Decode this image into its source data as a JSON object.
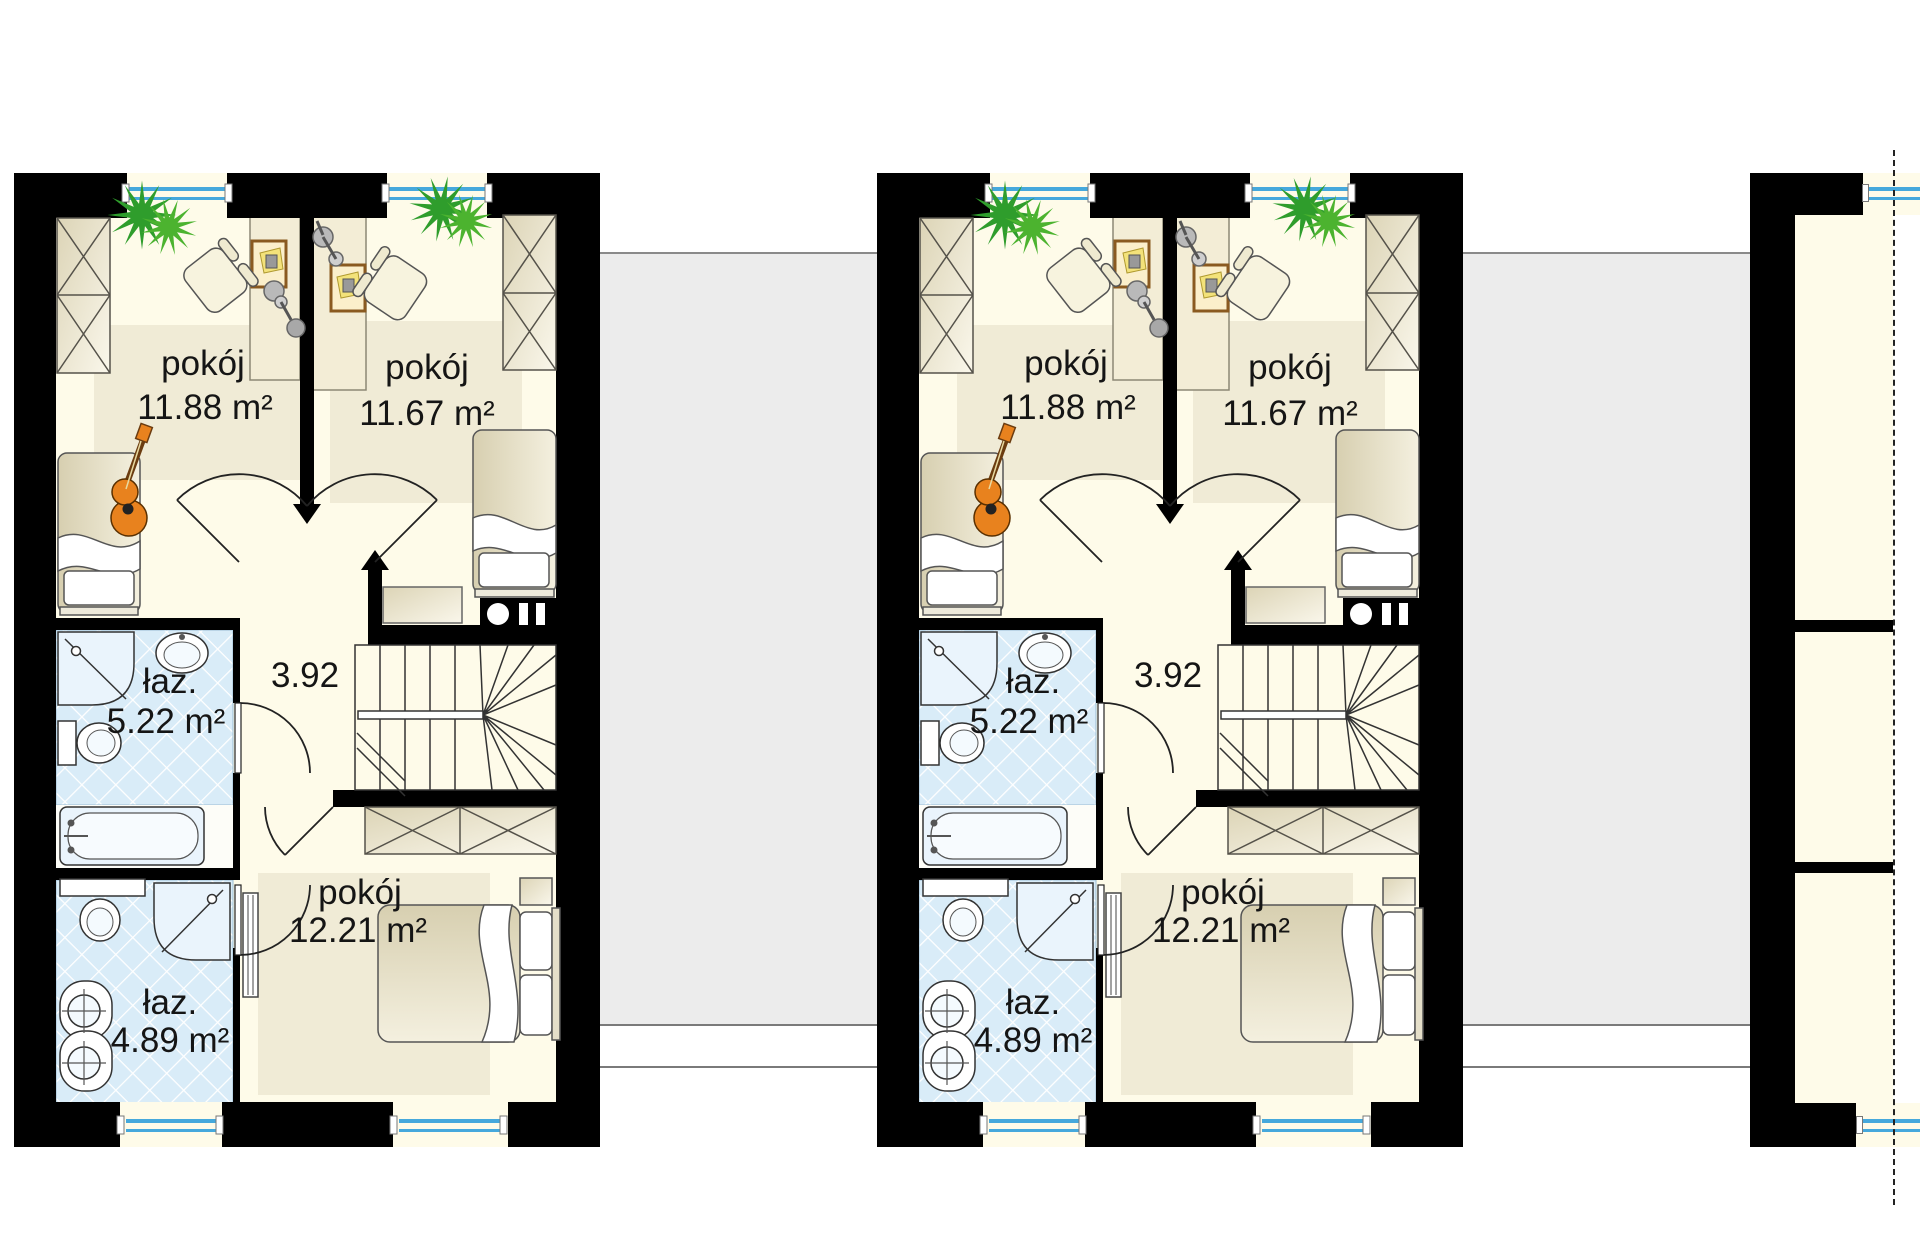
{
  "plan": {
    "rooms": {
      "bedroom_top_left": {
        "name": "pokój",
        "area": "11.88 m²"
      },
      "bedroom_top_right": {
        "name": "pokój",
        "area": "11.67 m²"
      },
      "bathroom_upper": {
        "name": "łaz.",
        "area": "5.22 m²"
      },
      "hallway": {
        "dimension": "3.92"
      },
      "bedroom_bottom": {
        "name": "pokój",
        "area": "12.21 m²"
      },
      "bathroom_lower": {
        "name": "łaz.",
        "area": "4.89 m²"
      }
    },
    "colors": {
      "wall": "#000000",
      "floor": "#FEFBE9",
      "floor_mat": "#F0EBD6",
      "bath_tile": "#D9ECF8",
      "window": "#45A8DC",
      "neighbor_gray": "#ECECEC",
      "plant_green": "#2F9D2C",
      "guitar_orange": "#E8821E"
    }
  }
}
